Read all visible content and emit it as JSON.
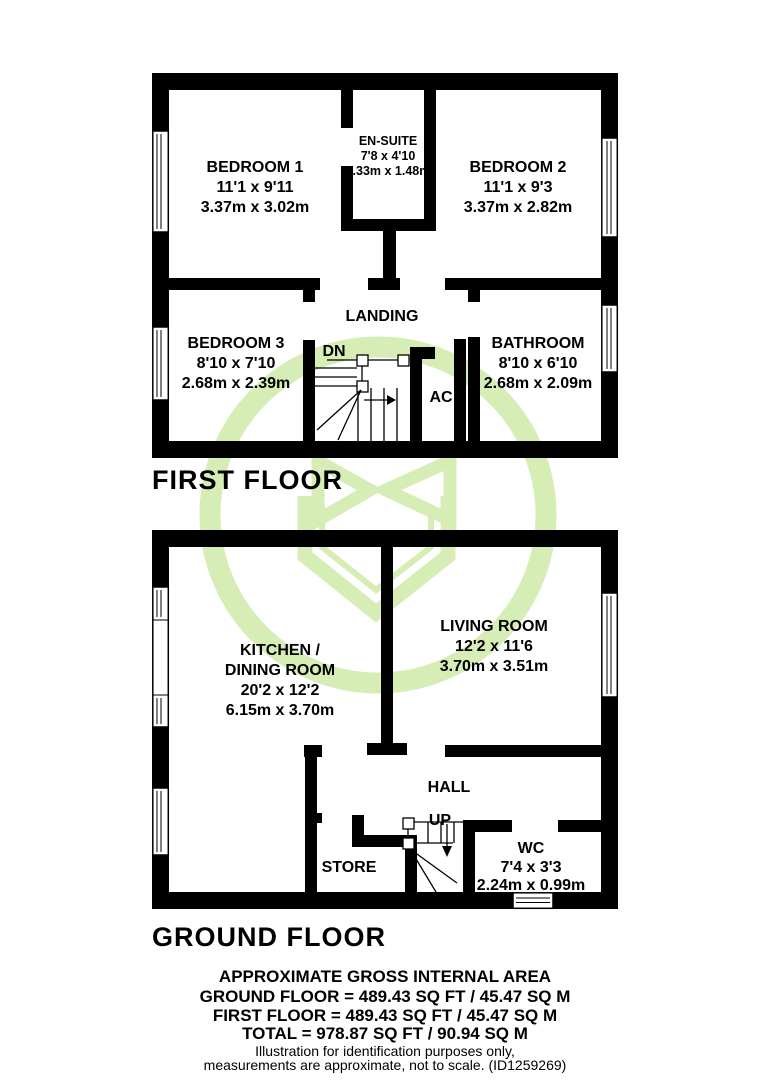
{
  "first_floor": {
    "title": "FIRST FLOOR",
    "bedroom1": {
      "name": "BEDROOM 1",
      "imperial": "11'1 x 9'11",
      "metric": "3.37m x 3.02m"
    },
    "ensuite": {
      "name": "EN-SUITE",
      "imperial": "7'8 x 4'10",
      "metric": "2.33m x 1.48m"
    },
    "bedroom2": {
      "name": "BEDROOM 2",
      "imperial": "11'1 x 9'3",
      "metric": "3.37m x 2.82m"
    },
    "landing": {
      "name": "LANDING"
    },
    "bedroom3": {
      "name": "BEDROOM 3",
      "imperial": "8'10 x 7'10",
      "metric": "2.68m x 2.39m"
    },
    "bathroom": {
      "name": "BATHROOM",
      "imperial": "8'10 x 6'10",
      "metric": "2.68m x 2.09m"
    },
    "stairs_label": "DN",
    "airing_cupboard_label": "AC"
  },
  "ground_floor": {
    "title": "GROUND FLOOR",
    "kitchen_dining": {
      "name_line1": "KITCHEN /",
      "name_line2": "DINING ROOM",
      "imperial": "20'2 x 12'2",
      "metric": "6.15m x 3.70m"
    },
    "living_room": {
      "name": "LIVING ROOM",
      "imperial": "12'2 x 11'6",
      "metric": "3.70m x 3.51m"
    },
    "hall": {
      "name": "HALL"
    },
    "store": {
      "name": "STORE"
    },
    "wc": {
      "name": "WC",
      "imperial": "7'4 x 3'3",
      "metric": "2.24m x 0.99m"
    },
    "stairs_label": "UP"
  },
  "footer": {
    "title": "APPROXIMATE GROSS INTERNAL AREA",
    "ground_floor_area": "GROUND FLOOR = 489.43 SQ FT / 45.47 SQ M",
    "first_floor_area": "FIRST FLOOR = 489.43 SQ FT / 45.47 SQ M",
    "total_area": "TOTAL = 978.87 SQ FT / 90.94 SQ M",
    "disclaimer_line1": "Illustration for identification purposes only,",
    "disclaimer_line2": "measurements are approximate, not to scale. (ID1259269)"
  },
  "watermark_color": "#d7edb6",
  "wall_color": "#000000",
  "background_color": "#ffffff"
}
